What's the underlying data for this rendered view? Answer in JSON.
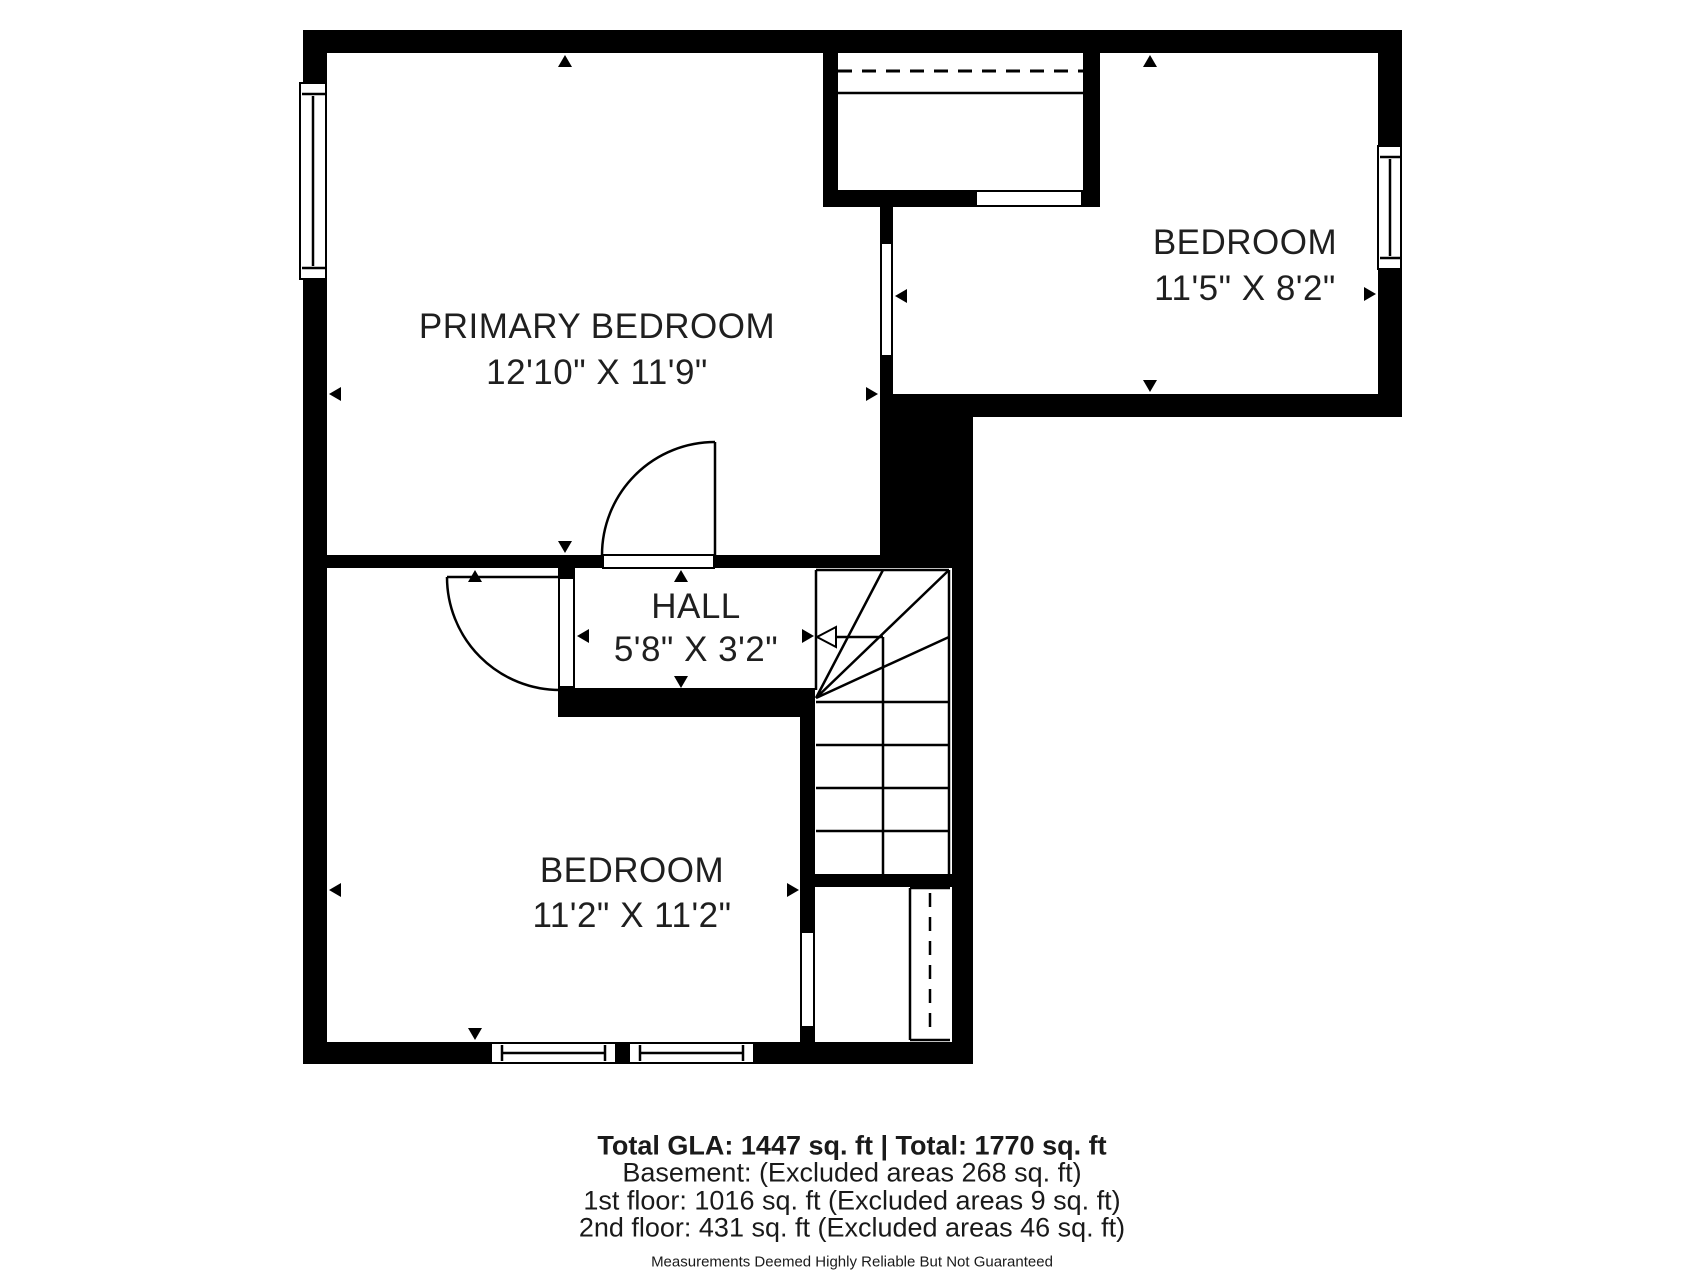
{
  "colors": {
    "wall": "#000000",
    "text": "#1f1f1f",
    "background": "#ffffff"
  },
  "rooms": [
    {
      "id": "primary-bedroom",
      "name": "PRIMARY BEDROOM",
      "dims": "12'10\" X 11'9\""
    },
    {
      "id": "bedroom-upper-right",
      "name": "BEDROOM",
      "dims": "11'5\" X 8'2\""
    },
    {
      "id": "hall",
      "name": "HALL",
      "dims": "5'8\" X 3'2\""
    },
    {
      "id": "bedroom-lower",
      "name": "BEDROOM",
      "dims": "11'2\" X 11'2\""
    }
  ],
  "summary": {
    "total": "Total GLA: 1447 sq. ft | Total: 1770 sq. ft",
    "basement": "Basement: (Excluded areas 268 sq. ft)",
    "first_floor": "1st floor: 1016 sq. ft (Excluded areas 9 sq. ft)",
    "second_floor": "2nd floor: 431 sq. ft (Excluded areas 46 sq. ft)",
    "disclaimer": "Measurements Deemed Highly Reliable But Not Guaranteed"
  },
  "icons": {
    "measurement_arrow": "solid black triangle (dimension extent marker)",
    "stair_direction_arrow": "open left-pointing arrow on stair run",
    "window_symbol": "double-line rectangle in wall",
    "door_symbol": "quarter-circle swing arc with leaf line",
    "closet_rod": "dashed line",
    "closet_shelf": "solid thin line"
  }
}
